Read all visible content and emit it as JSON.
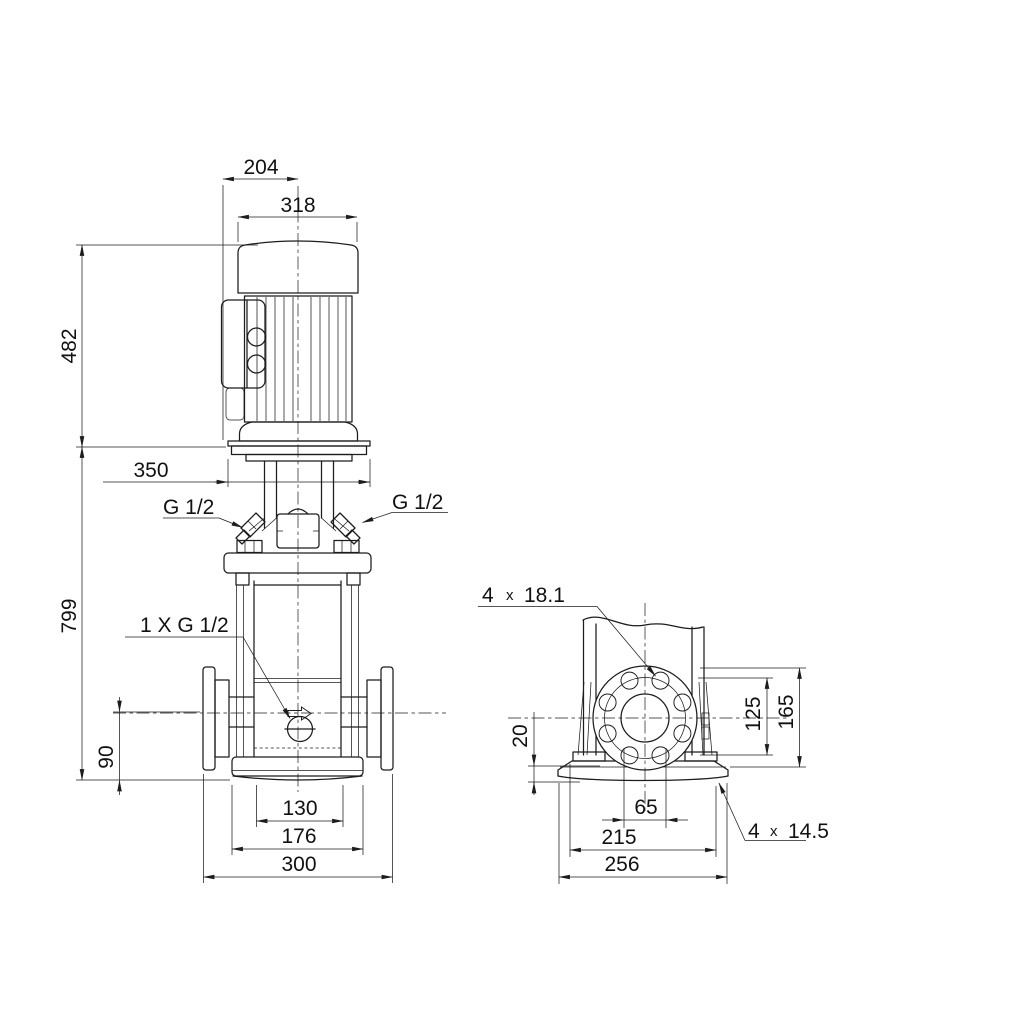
{
  "colors": {
    "ink": "#1c1c1c",
    "background": "#ffffff"
  },
  "front_view": {
    "dim_box_to_centre": "204",
    "dim_motor_width": "318",
    "dim_motor_height": "482",
    "dim_motor_flange_width": "350",
    "dim_pump_height": "799",
    "dim_port_centre_height": "90",
    "dim_base_inner_width": "130",
    "dim_base_width": "176",
    "dim_flange_face_to_face": "300",
    "label_plug_left": "G 1/2",
    "label_plug_right": "G 1/2",
    "label_drain_plug": "1 X G 1/2"
  },
  "side_view": {
    "flange_holes_count": "4",
    "flange_holes_times": "x",
    "flange_holes_diameter": "18.1",
    "dim_baseplate_thickness": "20",
    "dim_bolt_circle_top": "125",
    "dim_flange_top": "165",
    "dim_flange_hole_spacing": "65",
    "dim_base_hole_spacing": "215",
    "dim_baseplate_width": "256",
    "base_holes_count": "4",
    "base_holes_times": "x",
    "base_holes_diameter": "14.5"
  }
}
